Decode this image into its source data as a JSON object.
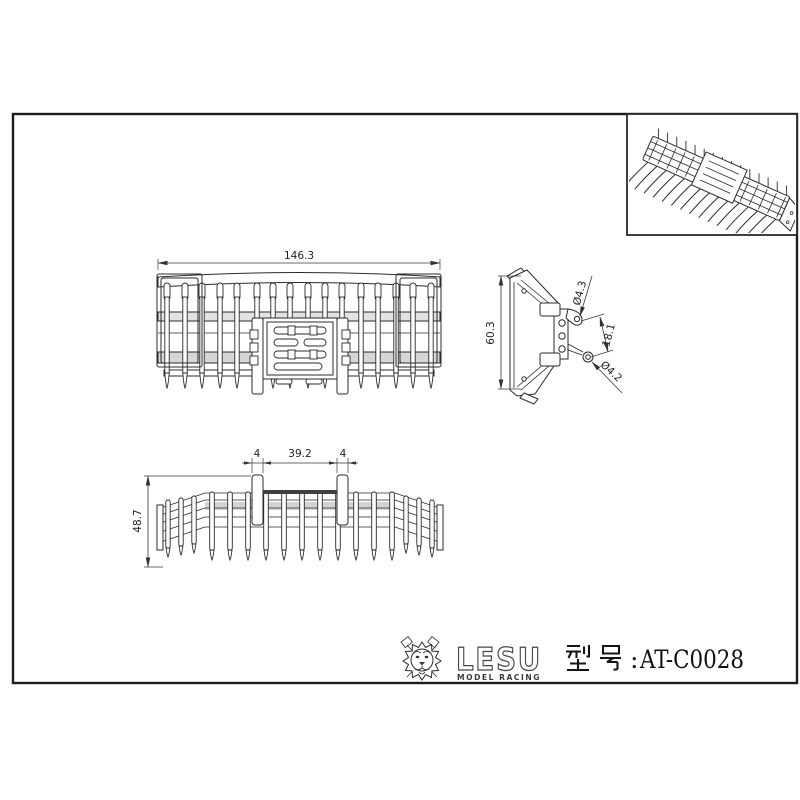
{
  "page": {
    "background": "#ffffff",
    "frame_color": "#1c1c1c",
    "line_color": "#2b2b2b"
  },
  "drawing": {
    "views": {
      "front": {
        "dim_overall_width": "146.3"
      },
      "side": {
        "dim_overall_height": "60.3",
        "dim_hole_top": "Ø4.3",
        "dim_hole_spacing": "18.1",
        "dim_hole_bottom": "Ø4.2"
      },
      "bottom": {
        "dim_post_left_width": "4",
        "dim_post_spacing": "39.2",
        "dim_post_right_width": "4",
        "dim_overall_depth": "48.7"
      }
    }
  },
  "title_block": {
    "brand": "LESU",
    "brand_subtitle": "MODEL RACING",
    "model_label": "型号:AT-C0028",
    "model_prefix": "型号",
    "model_separator": ":",
    "model_code": "AT-C0028"
  }
}
